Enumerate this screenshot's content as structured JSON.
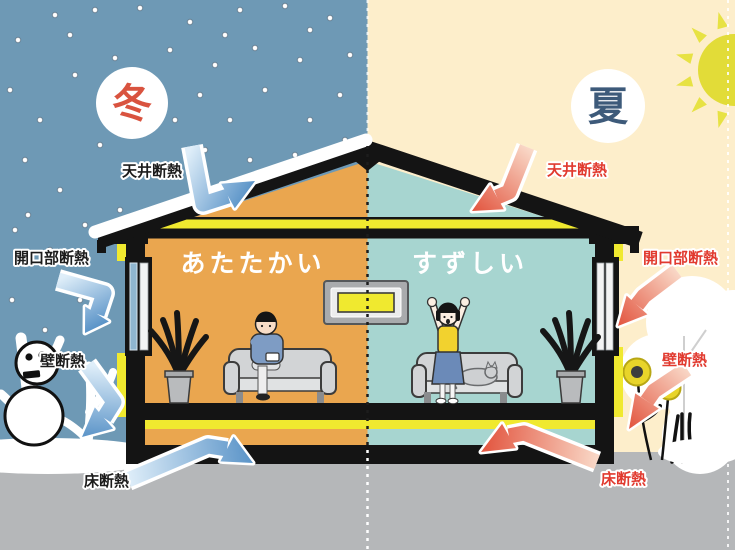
{
  "scene": {
    "winter": {
      "season": "冬",
      "room_feeling": "あたたかい",
      "insulation_labels": {
        "ceiling": "天井断熱",
        "opening": "開口部断熱",
        "wall": "壁断熱",
        "floor": "床断熱"
      },
      "colors": {
        "sky": "#6e99b5",
        "room": "#eaa64f",
        "season_text": "#d9533f",
        "label_text": "#1c1c1c",
        "arrow_light": "#dfeef9",
        "arrow_dark": "#5b94c8"
      }
    },
    "summer": {
      "season": "夏",
      "room_feeling": "すずしい",
      "insulation_labels": {
        "ceiling": "天井断熱",
        "opening": "開口部断熱",
        "wall": "壁断熱",
        "floor": "床断熱"
      },
      "colors": {
        "sky": "#fdeecb",
        "room": "#a7d5d0",
        "season_text": "#3d5a7a",
        "label_text": "#e13a2f",
        "arrow_light": "#f9d8c7",
        "arrow_dark": "#e2543e"
      }
    },
    "shared": {
      "colors": {
        "structure": "#141414",
        "insulation_yellow": "#f0e92f",
        "ground": "#b5b7b9",
        "snow": "#ffffff",
        "sun": "#e2dc38"
      }
    }
  }
}
